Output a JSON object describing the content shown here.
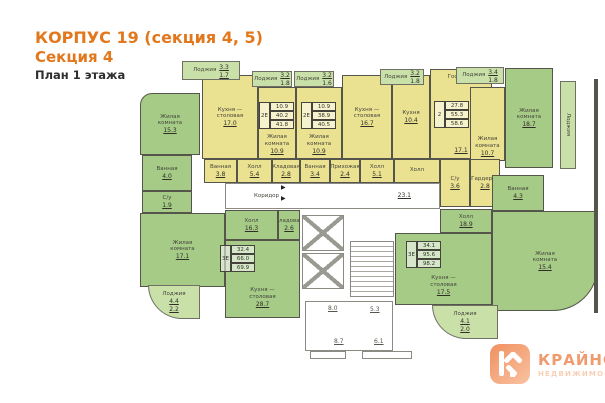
{
  "title": {
    "line1": "КОРПУС 19 (секция 4, 5)",
    "line2": "Секция 4",
    "line3": "План 1 этажа"
  },
  "colors": {
    "accent_orange": "#e2771c",
    "room_green": "#a5cb87",
    "room_yellow": "#ebe291",
    "loggia_green": "#c9e0a9",
    "wall": "#56554b"
  },
  "icons": {
    "entrance_arrow": "▶"
  },
  "plan": {
    "corridor": {
      "label": "Коридор",
      "area": "23.1"
    },
    "rooms": {
      "livTL": {
        "label": "Жилая\nкомната",
        "area": "15.3"
      },
      "bathTL": {
        "label": "Ванная",
        "area": "4.0"
      },
      "wcTL": {
        "label": "С/у",
        "area": "1.9"
      },
      "livBL": {
        "label": "Жилая\nкомната",
        "area": "17.1"
      },
      "hallBL": {
        "label": "Холл",
        "area": "16.3"
      },
      "storeBL": {
        "label": "Кладовая",
        "area": "2.6"
      },
      "kitBL": {
        "label": "Кухня —\nстоловая",
        "area": "28.7"
      },
      "kit1": {
        "label": "Кухня —\nстоловая",
        "area": "17.0"
      },
      "liv1": {
        "label": "Жилая\nкомната",
        "area": "10.9"
      },
      "liv2": {
        "label": "Жилая\nкомната",
        "area": "10.9"
      },
      "kit2": {
        "label": "Кухня —\nстоловая",
        "area": "16.7"
      },
      "kit3": {
        "label": "Кухня",
        "area": "10.4"
      },
      "gost3": {
        "label": "Гостиная",
        "area": "17.1"
      },
      "liv3": {
        "label": "Жилая\nкомната",
        "area": "10.7"
      },
      "bath1": {
        "label": "Ванная",
        "area": "3.8"
      },
      "hall1": {
        "label": "Холл",
        "area": "5.4"
      },
      "store1": {
        "label": "Кладовая",
        "area": "2.8"
      },
      "bath2": {
        "label": "Ванная",
        "area": "3.4"
      },
      "entry2": {
        "label": "Прихожая",
        "area": "2.4"
      },
      "hall2": {
        "label": "Холл",
        "area": "5.1"
      },
      "hall3": {
        "label": "Холл",
        "area": ""
      },
      "wc3": {
        "label": "С/у",
        "area": "3.6"
      },
      "ward3": {
        "label": "Гардероб",
        "area": "2.8"
      },
      "livTR": {
        "label": "Жилая\nкомната",
        "area": "18.7"
      },
      "bathR": {
        "label": "Ванная",
        "area": "4.3"
      },
      "hallR": {
        "label": "Холл",
        "area": "18.9"
      },
      "kitR": {
        "label": "Кухня —\nстоловая",
        "area": "17.5"
      },
      "livR2": {
        "label": "Жилая\nкомната",
        "area": "15.4"
      }
    },
    "loggias": {
      "lTL": {
        "label": "Лоджия",
        "a1": "3.3",
        "a2": "1.7"
      },
      "lT2": {
        "label": "Лоджия",
        "a1": "3.2",
        "a2": "1.8"
      },
      "lT3": {
        "label": "Лоджия",
        "a1": "3.2",
        "a2": "1.6"
      },
      "lT4": {
        "label": "Лоджия",
        "a1": "3.2",
        "a2": "1.8"
      },
      "lTR": {
        "label": "Лоджия",
        "a1": "3.4",
        "a2": "1.8"
      },
      "lR": {
        "label": "Лоджия"
      },
      "lBL": {
        "label": "Лоджия",
        "a1": "4.4",
        "a2": "2.2"
      },
      "lBR": {
        "label": "Лоджия",
        "a1": "4.1",
        "a2": "2.0"
      }
    },
    "stamps": {
      "s1": {
        "type": "2Е",
        "v1": "10.9",
        "v2": "40.2",
        "v3": "41.8"
      },
      "s2": {
        "type": "2Е",
        "v1": "10.9",
        "v2": "38.9",
        "v3": "40.5"
      },
      "s3": {
        "type": "2",
        "v1": "27.8",
        "v2": "55.3",
        "v3": "58.6"
      },
      "s4": {
        "type": "3Е",
        "v1": "32.4",
        "v2": "66.0",
        "v3": "69.9"
      },
      "s5": {
        "type": "3Е",
        "v1": "34.1",
        "v2": "95.6",
        "v3": "98.2"
      }
    },
    "dims": {
      "d1": "8.0",
      "d2": "5.3",
      "d3": "8.7",
      "d4": "6.1"
    }
  },
  "logo": {
    "letter": "К",
    "name": "КРАЙНОВ",
    "subtitle": "НЕДВИЖИМОСТЬ"
  }
}
